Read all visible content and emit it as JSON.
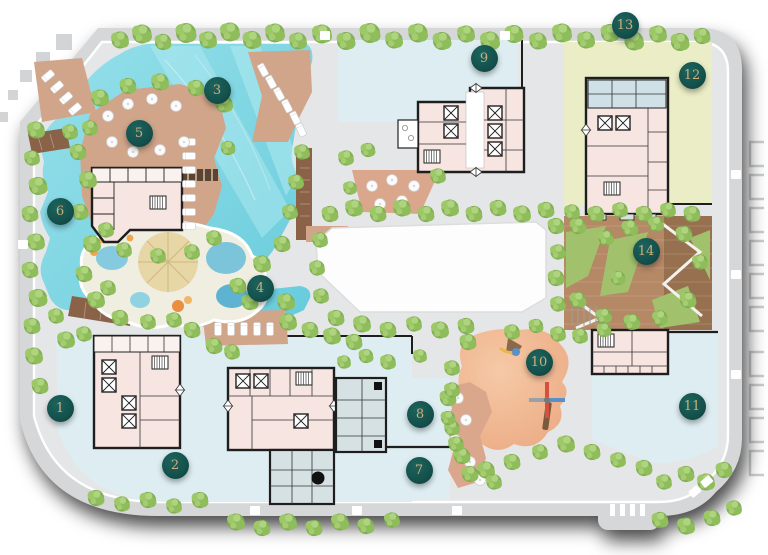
{
  "site_plan": {
    "markers": [
      {
        "label": "1",
        "x": 60,
        "y": 408
      },
      {
        "label": "2",
        "x": 175,
        "y": 465
      },
      {
        "label": "3",
        "x": 217,
        "y": 90
      },
      {
        "label": "4",
        "x": 260,
        "y": 288
      },
      {
        "label": "5",
        "x": 139,
        "y": 133
      },
      {
        "label": "6",
        "x": 60,
        "y": 211
      },
      {
        "label": "7",
        "x": 419,
        "y": 470
      },
      {
        "label": "8",
        "x": 420,
        "y": 414
      },
      {
        "label": "9",
        "x": 484,
        "y": 58
      },
      {
        "label": "10",
        "x": 539,
        "y": 362
      },
      {
        "label": "11",
        "x": 692,
        "y": 406
      },
      {
        "label": "12",
        "x": 692,
        "y": 75
      },
      {
        "label": "13",
        "x": 625,
        "y": 25
      },
      {
        "label": "14",
        "x": 646,
        "y": 251
      }
    ],
    "marker_style": {
      "background": "#14514c",
      "text_color": "#cfae7b"
    },
    "palette": {
      "road": "#d5d7d8",
      "ground": "#e5e6e7",
      "pool": "#7ed5e2",
      "pool_light": "#b6ebf1",
      "plaza": "#ddedf1",
      "lawn": "#eaedc5",
      "deck": "#d0a58a",
      "terracotta": "#dba78c",
      "wood": "#8a6248",
      "garden_wood": "#b58866",
      "garden_wood_dark": "#97714f",
      "lawn_patch": "#a2c16c",
      "playground": "#efb392",
      "tree": "#8ab957",
      "building_fill": "#f7e5e2",
      "building_service": "#d6e1e4",
      "building_blue": "#cfe0e6",
      "outline": "#1e1e1e",
      "water_play": "#f0ede1",
      "sand": "#e8d7a6"
    }
  }
}
